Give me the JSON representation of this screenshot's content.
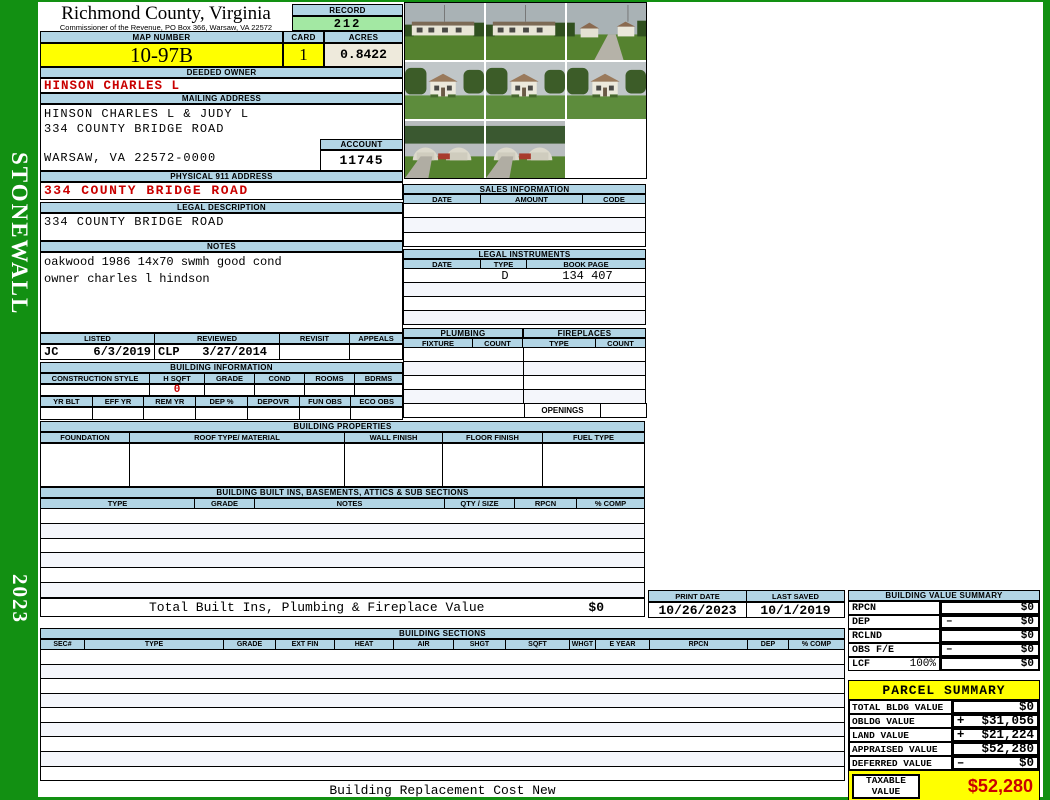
{
  "county": {
    "title": "Richmond County, Virginia",
    "subtitle": "Commissioner of the Revenue, PO Box 366, Warsaw, VA 22572"
  },
  "sidebar": {
    "district": "STONEWALL",
    "year": "2023"
  },
  "record": {
    "label": "RECORD",
    "value": "212"
  },
  "map": {
    "label": "MAP NUMBER",
    "value": "10-97B"
  },
  "card": {
    "label": "CARD",
    "value": "1"
  },
  "acres": {
    "label": "ACRES",
    "value": "0.8422"
  },
  "deeded_owner": {
    "label": "DEEDED OWNER",
    "value": "HINSON CHARLES L"
  },
  "mailing": {
    "label": "MAILING ADDRESS",
    "line1": "HINSON CHARLES L & JUDY L",
    "line2": "334 COUNTY BRIDGE ROAD",
    "line3": "WARSAW, VA 22572-0000"
  },
  "account": {
    "label": "ACCOUNT",
    "value": "11745"
  },
  "physical911": {
    "label": "PHYSICAL 911 ADDRESS",
    "value": "334 COUNTY BRIDGE ROAD"
  },
  "legal_description": {
    "label": "LEGAL DESCRIPTION",
    "value": "334 COUNTY BRIDGE ROAD"
  },
  "notes": {
    "label": "NOTES",
    "line1": "oakwood 1986 14x70 swmh good cond",
    "line2": "owner charles l hindson"
  },
  "review": {
    "columns": {
      "0": "LISTED",
      "1": "REVIEWED",
      "2": "REVISIT",
      "3": "APPEALS"
    },
    "listed_by": "JC",
    "listed_date": "6/3/2019",
    "reviewed_by": "CLP",
    "reviewed_date": "3/27/2014"
  },
  "building_information": {
    "label": "BUILDING INFORMATION",
    "row1": {
      "0": "CONSTRUCTION STYLE",
      "1": "H SQFT",
      "2": "GRADE",
      "3": "COND",
      "4": "ROOMS",
      "5": "BDRMS"
    },
    "h_sqft": "0",
    "row2": {
      "0": "YR BLT",
      "1": "EFF YR",
      "2": "REM YR",
      "3": "DEP %",
      "4": "DEPOVR",
      "5": "FUN OBS",
      "6": "ECO OBS"
    }
  },
  "building_properties": {
    "label": "BUILDING PROPERTIES",
    "columns": {
      "0": "FOUNDATION",
      "1": "ROOF TYPE/ MATERIAL",
      "2": "WALL FINISH",
      "3": "FLOOR FINISH",
      "4": "FUEL TYPE"
    }
  },
  "built_ins": {
    "label": "BUILDING BUILT INS, BASEMENTS, ATTICS & SUB SECTIONS",
    "columns": {
      "0": "TYPE",
      "1": "GRADE",
      "2": "NOTES",
      "3": "QTY / SIZE",
      "4": "RPCN",
      "5": "% COMP"
    },
    "total_label": "Total Built Ins, Plumbing & Fireplace Value",
    "total_value": "$0"
  },
  "sales": {
    "label": "SALES INFORMATION",
    "columns": {
      "0": "DATE",
      "1": "AMOUNT",
      "2": "CODE"
    }
  },
  "legal_instruments": {
    "label": "LEGAL INSTRUMENTS",
    "columns": {
      "0": "DATE",
      "1": "TYPE",
      "2": "BOOK PAGE"
    },
    "row1": {
      "type": "D",
      "book_page": "134 407"
    }
  },
  "plumbing": {
    "label": "PLUMBING",
    "columns": {
      "0": "FIXTURE",
      "1": "COUNT"
    }
  },
  "fireplaces": {
    "label": "FIREPLACES",
    "columns": {
      "0": "TYPE",
      "1": "COUNT"
    },
    "openings_label": "OPENINGS"
  },
  "print_info": {
    "print_date_label": "PRINT DATE",
    "print_date": "10/26/2023",
    "last_saved_label": "LAST SAVED",
    "last_saved": "10/1/2019"
  },
  "building_value_summary": {
    "label": "BUILDING VALUE SUMMARY",
    "rows": {
      "0": {
        "label": "RPCN",
        "pct": "",
        "op": "",
        "value": "$0"
      },
      "1": {
        "label": "DEP",
        "pct": "",
        "op": "–",
        "value": "$0"
      },
      "2": {
        "label": "RCLND",
        "pct": "",
        "op": "",
        "value": "$0"
      },
      "3": {
        "label": "OBS F/E",
        "pct": "",
        "op": "–",
        "value": "$0"
      },
      "4": {
        "label": "LCF",
        "pct": "100%",
        "op": "",
        "value": "$0"
      }
    }
  },
  "building_sections": {
    "label": "BUILDING SECTIONS",
    "columns": {
      "0": "SEC#",
      "1": "TYPE",
      "2": "GRADE",
      "3": "EXT FIN",
      "4": "HEAT",
      "5": "AIR",
      "6": "SHGT",
      "7": "SQFT",
      "8": "WHGT",
      "9": "E YEAR",
      "10": "RPCN",
      "11": "DEP",
      "12": "% COMP"
    }
  },
  "parcel_summary": {
    "label": "PARCEL SUMMARY",
    "rows": {
      "0": {
        "label": "TOTAL BLDG VALUE",
        "op": "",
        "value": "$0"
      },
      "1": {
        "label": "OBLDG VALUE",
        "op": "+",
        "value": "$31,056"
      },
      "2": {
        "label": "LAND VALUE",
        "op": "+",
        "value": "$21,224"
      },
      "3": {
        "label": "APPRAISED VALUE",
        "op": "",
        "value": "$52,280"
      },
      "4": {
        "label": "DEFERRED VALUE",
        "op": "–",
        "value": "$0"
      }
    },
    "taxable_label_line1": "TAXABLE",
    "taxable_label_line2": "VALUE",
    "taxable_value": "$52,280"
  },
  "footer": {
    "caption": "Building Replacement Cost New"
  },
  "photos": {
    "count": "8",
    "description": "property photographs of mobile home and outbuildings"
  },
  "colors": {
    "header_blue": "#b2d5e5",
    "record_green": "#a3e8a3",
    "highlight_yellow": "#ffff00",
    "acres_cream": "#eeeadc",
    "alert_red": "#c90000",
    "frame_green": "#129012"
  }
}
